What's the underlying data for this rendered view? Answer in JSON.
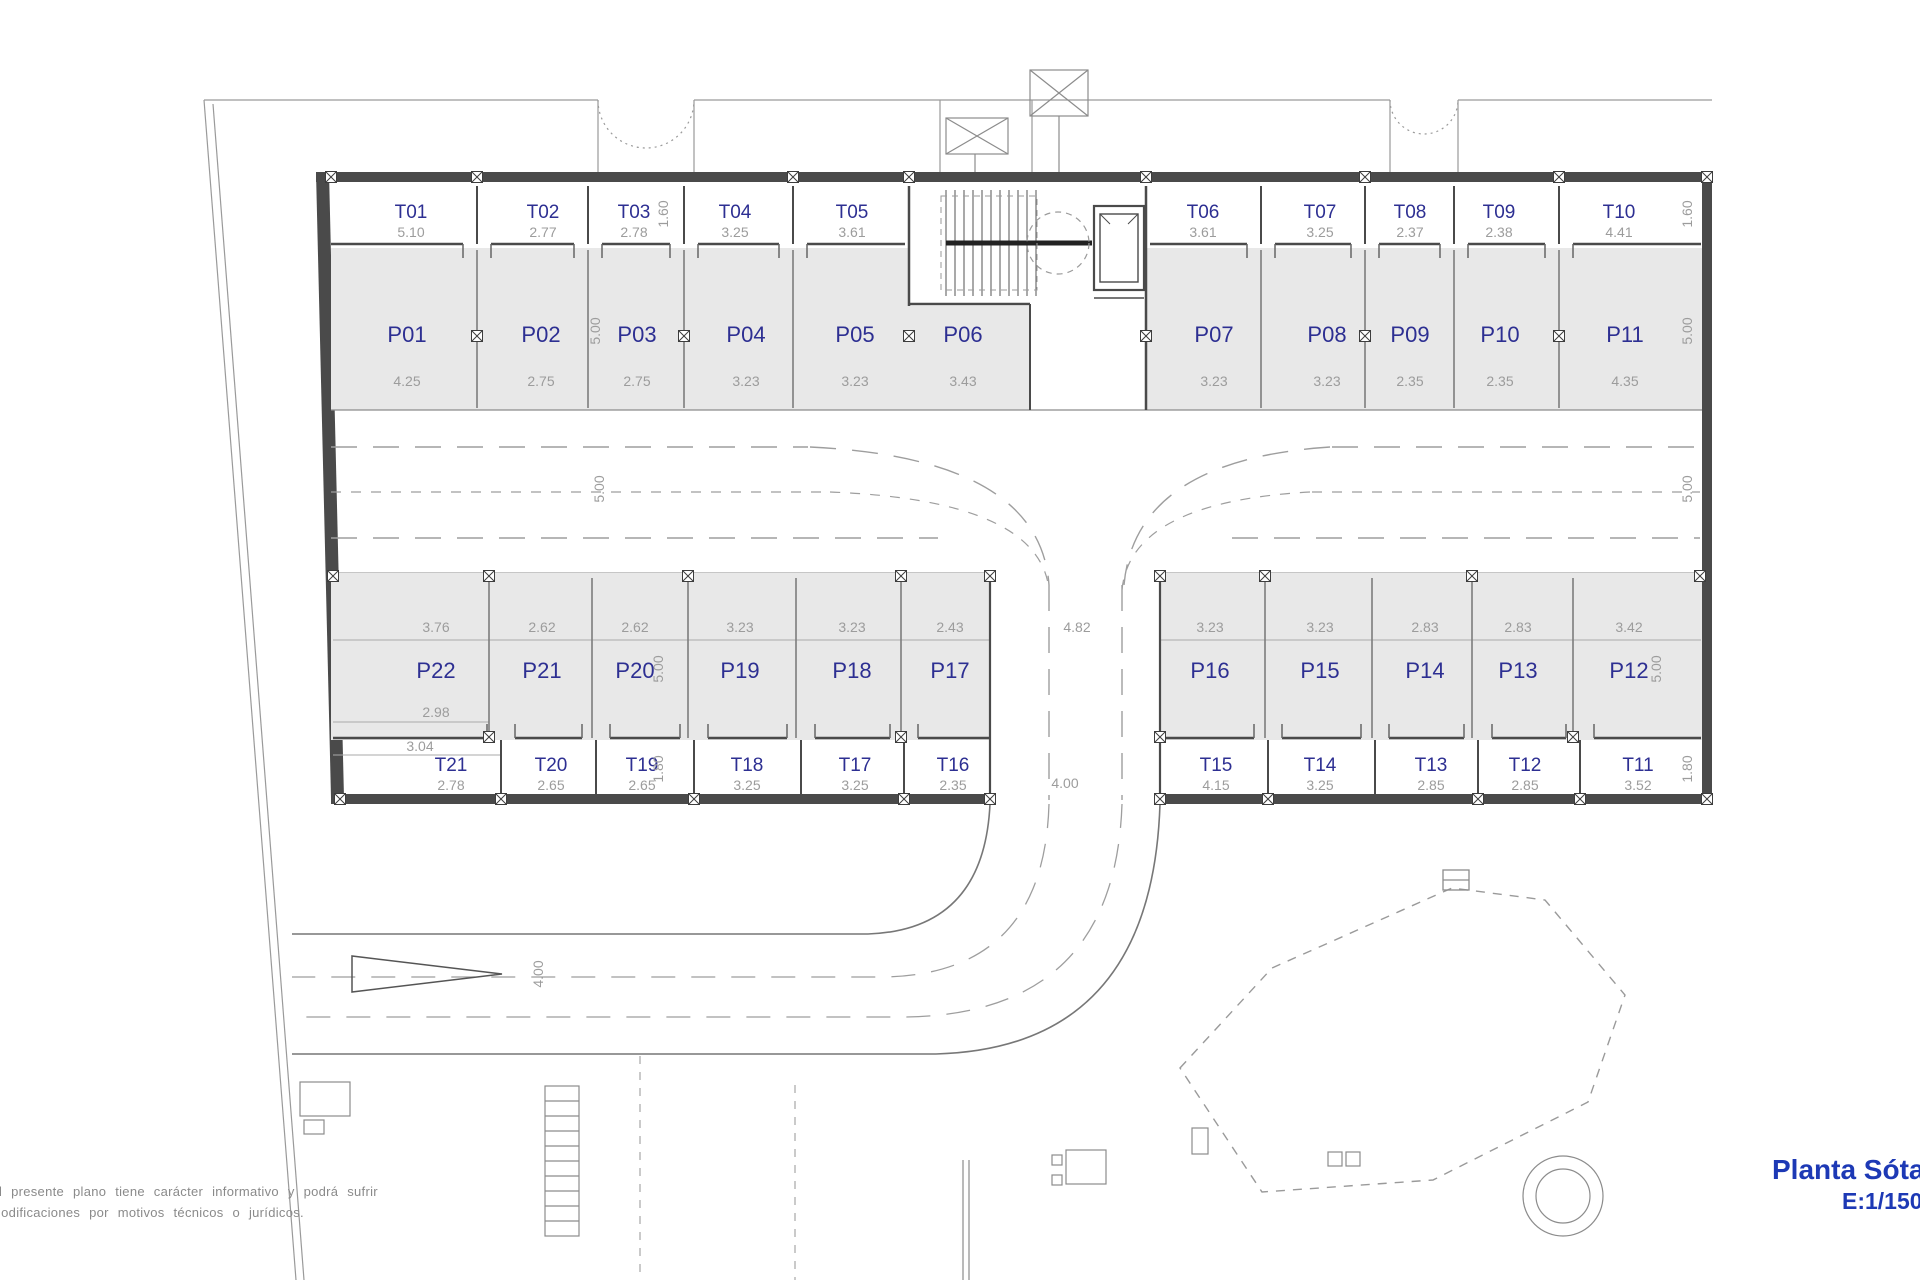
{
  "title_block": {
    "title": "Planta Sótano",
    "scale": "E:1/150"
  },
  "disclaimer": {
    "line1": "El presente plano tiene carácter informativo y podrá sufrir",
    "line2": "modificaciones por motivos técnicos o jurídicos."
  },
  "colors": {
    "label_blue": "#2d2f92",
    "title_blue": "#1d39b5",
    "dim_gray": "#9c9c9c",
    "wall_dark": "#4a4a4a",
    "stall_fill": "#e8e8e8"
  },
  "plan": {
    "storage_top": [
      {
        "id": "T01",
        "width": "5.10"
      },
      {
        "id": "T02",
        "width": "2.77"
      },
      {
        "id": "T03",
        "width": "2.78"
      },
      {
        "id": "T04",
        "width": "3.25"
      },
      {
        "id": "T05",
        "width": "3.61"
      },
      {
        "id": "T06",
        "width": "3.61"
      },
      {
        "id": "T07",
        "width": "3.25"
      },
      {
        "id": "T08",
        "width": "2.37"
      },
      {
        "id": "T09",
        "width": "2.38"
      },
      {
        "id": "T10",
        "width": "4.41"
      }
    ],
    "parking_top": [
      {
        "id": "P01",
        "width": "4.25"
      },
      {
        "id": "P02",
        "width": "2.75"
      },
      {
        "id": "P03",
        "width": "2.75"
      },
      {
        "id": "P04",
        "width": "3.23"
      },
      {
        "id": "P05",
        "width": "3.23"
      },
      {
        "id": "P06",
        "width": "3.43"
      },
      {
        "id": "P07",
        "width": "3.23"
      },
      {
        "id": "P08",
        "width": "3.23"
      },
      {
        "id": "P09",
        "width": "2.35"
      },
      {
        "id": "P10",
        "width": "2.35"
      },
      {
        "id": "P11",
        "width": "4.35"
      }
    ],
    "parking_bottom": [
      {
        "id": "P22",
        "width": "3.76"
      },
      {
        "id": "P21",
        "width": "2.62"
      },
      {
        "id": "P20",
        "width": "2.62"
      },
      {
        "id": "P19",
        "width": "3.23"
      },
      {
        "id": "P18",
        "width": "3.23"
      },
      {
        "id": "P17",
        "width": "2.43"
      },
      {
        "id": "P16",
        "width": "3.23"
      },
      {
        "id": "P15",
        "width": "3.23"
      },
      {
        "id": "P14",
        "width": "2.83"
      },
      {
        "id": "P13",
        "width": "2.83"
      },
      {
        "id": "P12",
        "width": "3.42"
      }
    ],
    "storage_bottom": [
      {
        "id": "T21",
        "width": "2.78"
      },
      {
        "id": "T20",
        "width": "2.65"
      },
      {
        "id": "T19",
        "width": "2.65"
      },
      {
        "id": "T18",
        "width": "3.25"
      },
      {
        "id": "T17",
        "width": "3.25"
      },
      {
        "id": "T16",
        "width": "2.35"
      },
      {
        "id": "T15",
        "width": "4.15"
      },
      {
        "id": "T14",
        "width": "3.25"
      },
      {
        "id": "T13",
        "width": "2.85"
      },
      {
        "id": "T12",
        "width": "2.85"
      },
      {
        "id": "T11",
        "width": "3.52"
      }
    ],
    "dims": {
      "storage_depth_top": "1.60",
      "parking_depth_top": "5.00",
      "aisle_width": "5.00",
      "parking_depth_bottom": "5.00",
      "storage_depth_bottom": "1.80",
      "road_width_junction": "4.82",
      "road_width_lower": "4.00",
      "ramp_width": "4.00",
      "p22_inner_width": "2.98",
      "t21_outer_width": "3.04"
    }
  }
}
